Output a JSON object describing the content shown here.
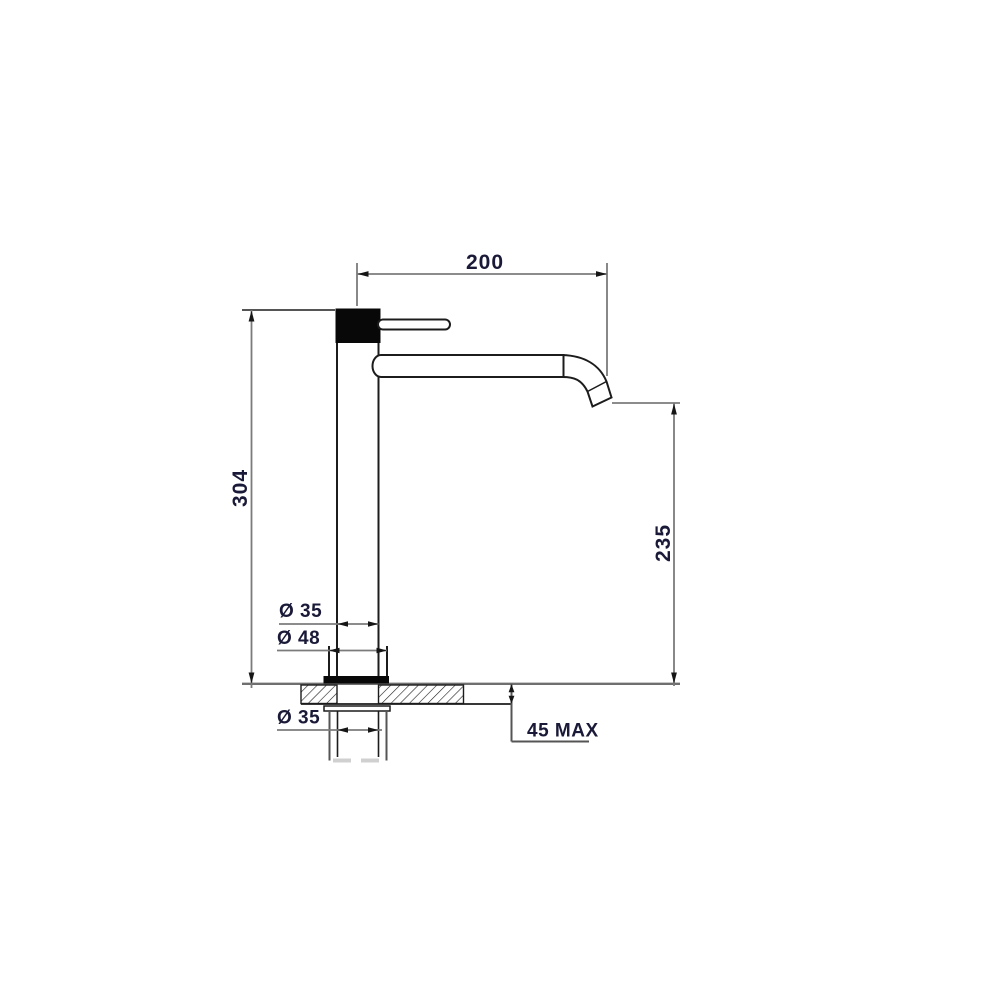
{
  "drawing": {
    "labels": {
      "spout_reach": "200",
      "overall_height": "304",
      "spout_outlet_height": "235",
      "body_diameter": "Ø 35",
      "base_diameter": "Ø 48",
      "shank_diameter": "Ø 35",
      "counter_max_thickness": "45 MAX"
    },
    "colors": {
      "background": "#ffffff",
      "outline": "#1c1c1c",
      "solid_fill": "#080808",
      "dimension_line": "#7b7b7b",
      "extension_dark": "#555555",
      "counter_line": "#6f6f6f",
      "arrow": "#161616",
      "label_text": "#1a1a38",
      "faint_line": "#d0d0d0"
    }
  }
}
